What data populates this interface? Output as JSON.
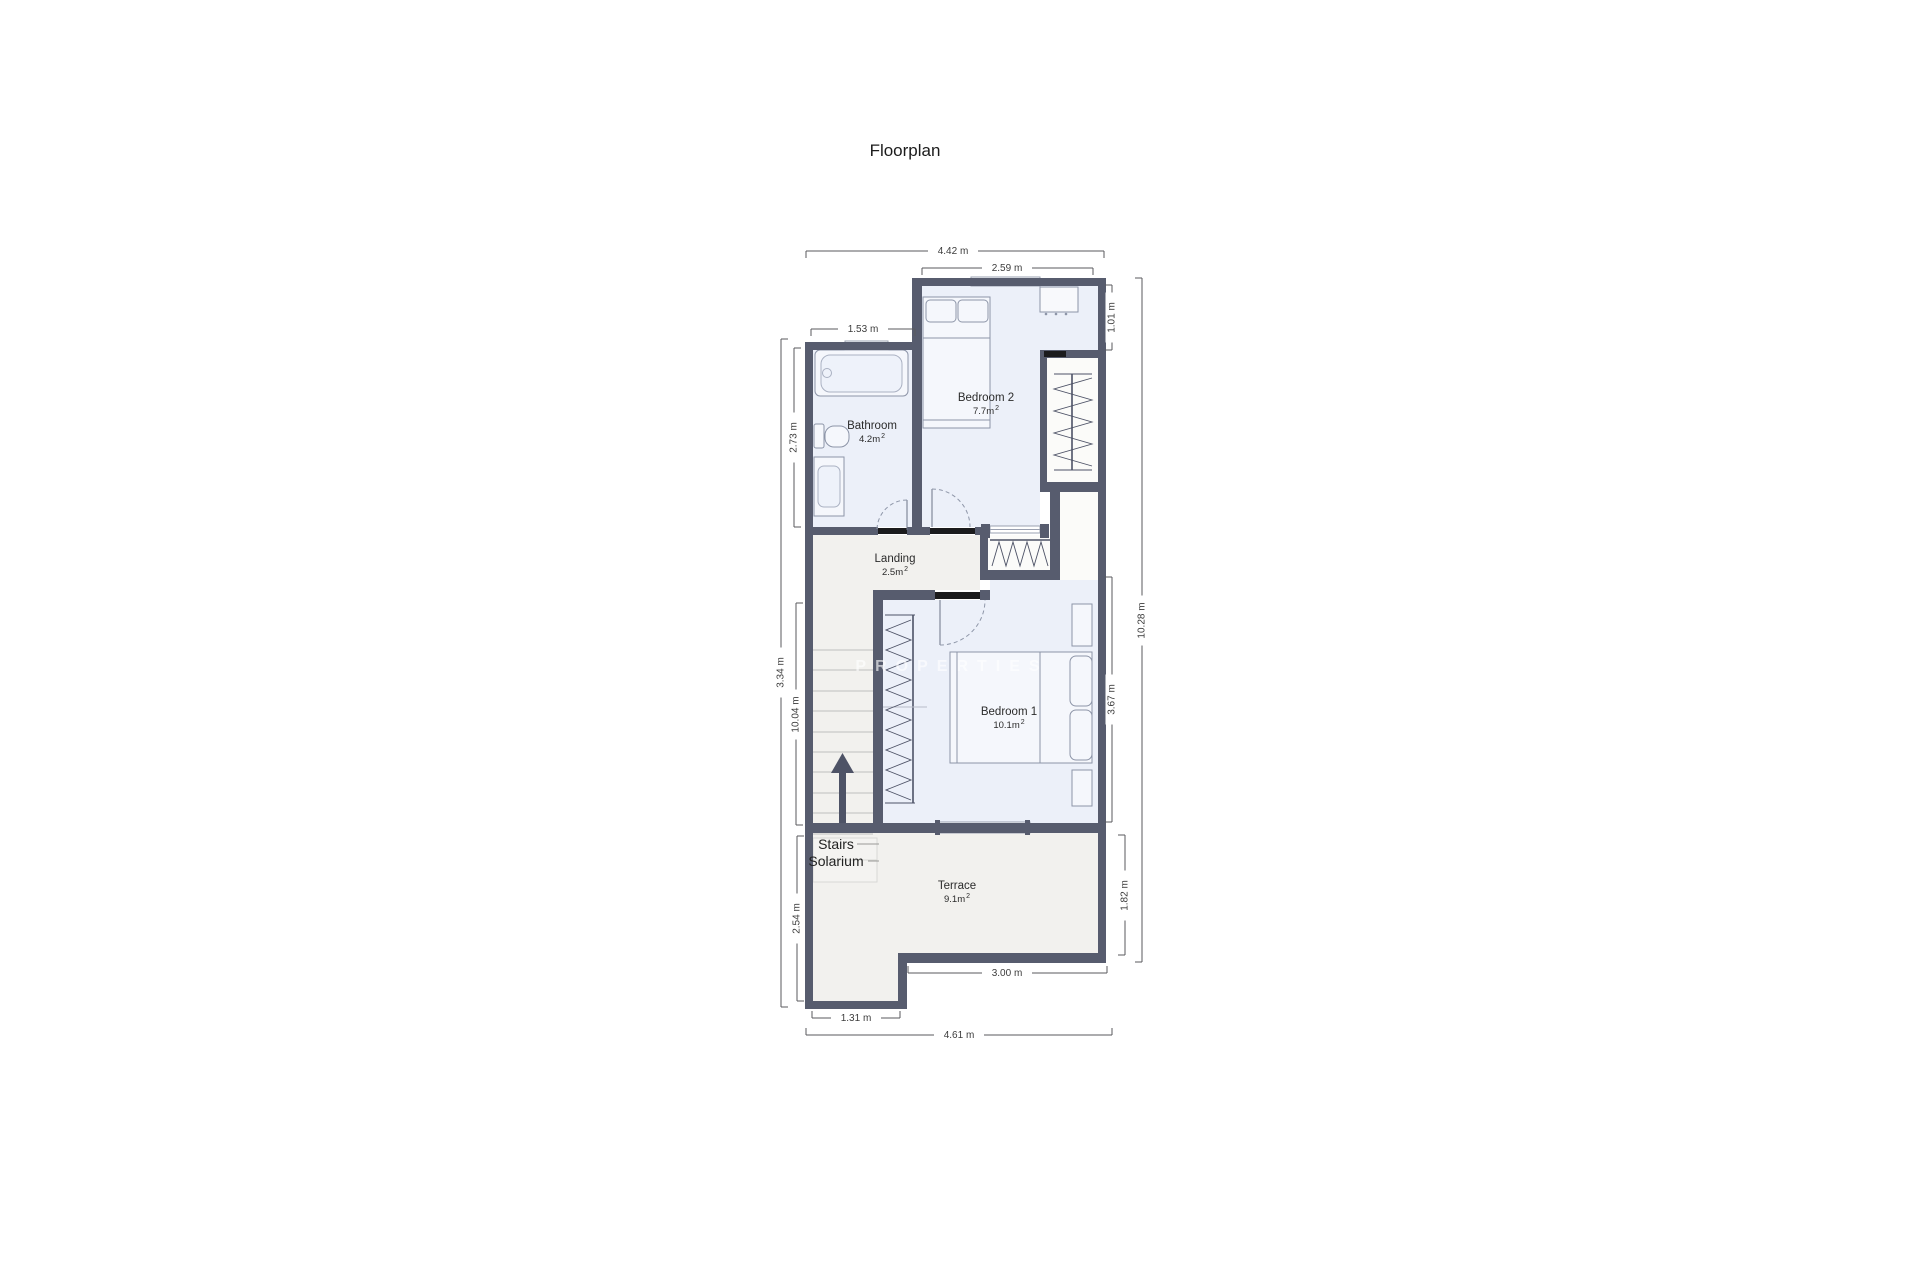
{
  "title": "Floorplan",
  "watermark": "PROPERTIES",
  "rooms": {
    "bathroom": {
      "name": "Bathroom",
      "area": "4.2m",
      "sup": "2"
    },
    "bedroom2": {
      "name": "Bedroom 2",
      "area": "7.7m",
      "sup": "2"
    },
    "landing": {
      "name": "Landing",
      "area": "2.5m",
      "sup": "2"
    },
    "bedroom1": {
      "name": "Bedroom 1",
      "area": "10.1m",
      "sup": "2"
    },
    "terrace": {
      "name": "Terrace",
      "area": "9.1m",
      "sup": "2"
    }
  },
  "stairs": {
    "line1": "Stairs",
    "line2": "Solarium"
  },
  "dimensions": {
    "top_total_width": "4.42 m",
    "bedroom2_width": "2.59 m",
    "bathroom_width": "1.53 m",
    "nook_height": "1.01 m",
    "bathroom_height": "2.73 m",
    "left_outer_height": "3.34 m",
    "left_inner_height": "10.04 m",
    "stairs_lower_height": "2.54 m",
    "bedroom1_height": "3.67 m",
    "terrace_height": "1.82 m",
    "right_total_height": "10.28 m",
    "terrace_bottom_width": "3.00 m",
    "wing_width": "1.31 m",
    "bottom_total_width": "4.61 m"
  },
  "colors": {
    "wall": "#575c6e",
    "threshold": "#1b1b1d",
    "room_blue": "#ecf0f9",
    "room_grey": "#f2f1ee",
    "closet_white": "#fbfbf9"
  }
}
